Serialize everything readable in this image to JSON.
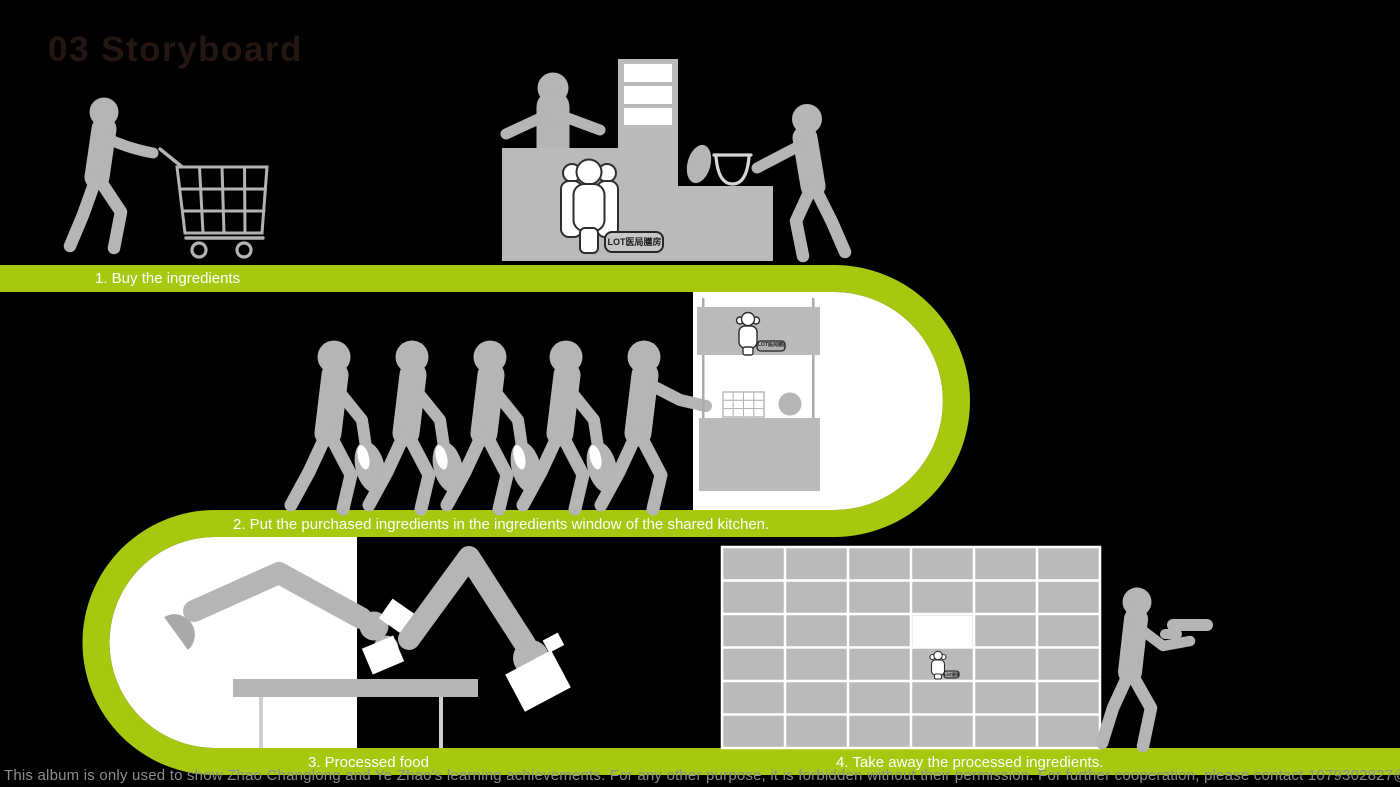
{
  "title": "03 Storyboard",
  "steps": [
    {
      "label": "1. Buy the ingredients"
    },
    {
      "label": "2. Put the purchased ingredients in the ingredients window of the shared kitchen."
    },
    {
      "label": "3. Processed food"
    },
    {
      "label": "4. Take away the processed ingredients."
    }
  ],
  "signs": {
    "lot_label": "LOT医局膳房"
  },
  "footer": {
    "disclaimer": "This album is only used to show Zhao Changlong and Ye Zhao's learning achievements. For any other purpose, it is forbidden without their permission. For further cooperation, please contact 1079302827@qq.com."
  },
  "colors": {
    "background": "#000000",
    "accent_green": "#a6c80e",
    "figure_gray": "#b5b5b5",
    "surface_gray": "#bababa",
    "white": "#ffffff",
    "label_text": "#ffffff",
    "disclaimer_text": "#8d8d8d",
    "title_text": "#241712"
  }
}
